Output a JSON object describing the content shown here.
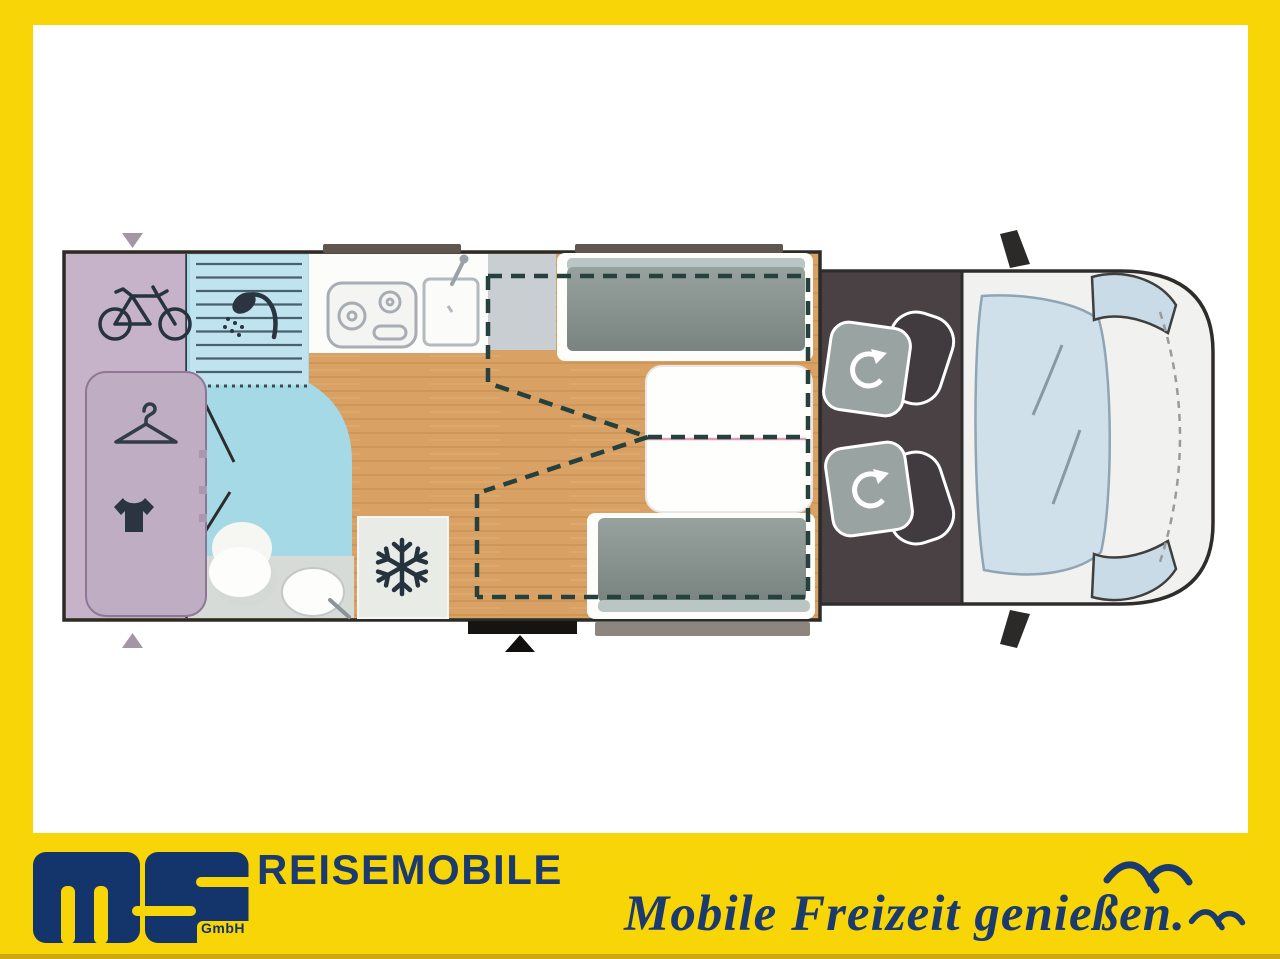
{
  "brand": {
    "division": "REISEMOBILE",
    "logo_suffix": "GmbH",
    "slogan": "Mobile Freizeit genießen.",
    "colors": {
      "banner_yellow": "#f7d506",
      "navy": "#1b3a6d"
    },
    "icons": [
      "ms-logo",
      "seagull-icon-large",
      "seagull-icon-small"
    ]
  },
  "floorplan": {
    "type": "motorhome-top-view",
    "zones": [
      {
        "name": "rear-garage",
        "icon": "bicycle-icon",
        "color": "#c6b3c9"
      },
      {
        "name": "wardrobe",
        "icons": [
          "hanger-icon",
          "tshirt-icon"
        ],
        "color": "#bfadc4"
      },
      {
        "name": "bathroom",
        "icons": [
          "shower-icon",
          "toilet-icon",
          "washbasin-icon"
        ],
        "color": "#a5d9e6"
      },
      {
        "name": "kitchen",
        "icons": [
          "hob-icon",
          "kitchen-sink-icon"
        ],
        "color": "#fcfcfa"
      },
      {
        "name": "refrigerator",
        "icon": "snowflake-icon",
        "color": "#e9ebe7"
      },
      {
        "name": "dinette",
        "features": [
          "bench-seat-front",
          "bench-seat-rear",
          "table",
          "drop-down-bed-dashed-outline"
        ],
        "floor": "#d9a164"
      },
      {
        "name": "cab",
        "features": [
          "swivel-seat-left",
          "swivel-seat-right",
          "windshield",
          "headlight-top",
          "headlight-bottom",
          "side-mirror-top",
          "side-mirror-bottom"
        ],
        "color": "#4a4145"
      }
    ],
    "markers": [
      "garage-door-arrow-top",
      "garage-door-arrow-bottom",
      "entry-door-arrow"
    ]
  }
}
